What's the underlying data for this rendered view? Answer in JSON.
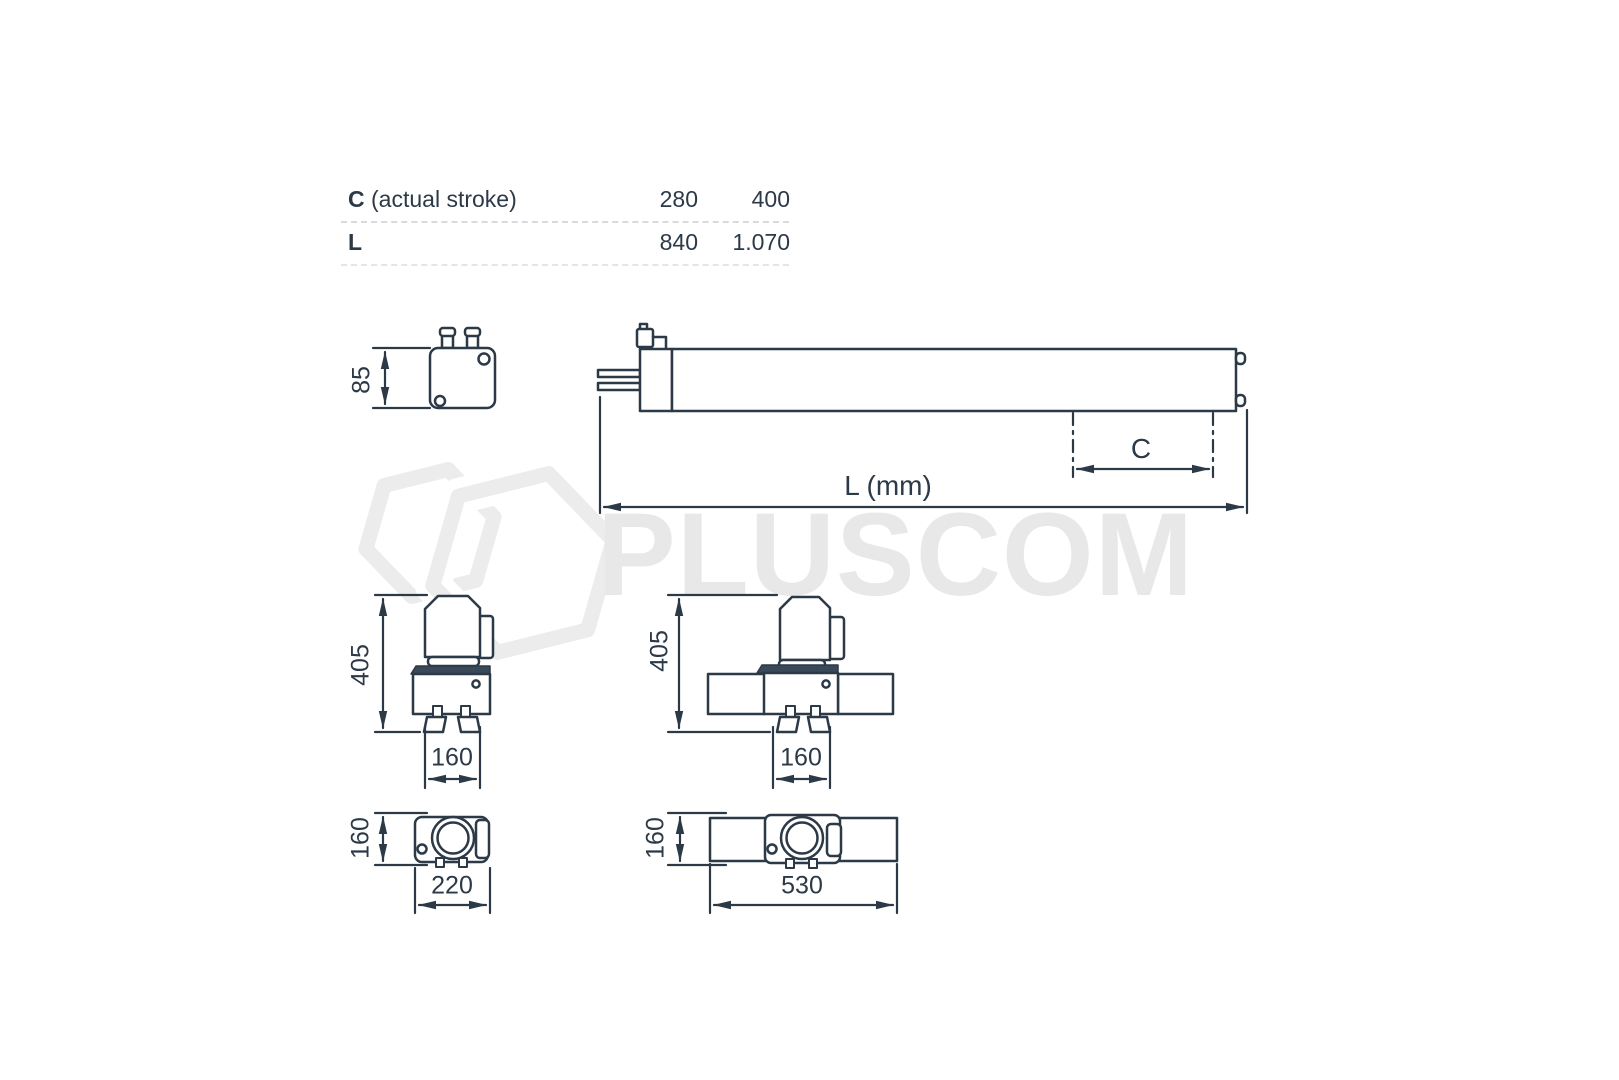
{
  "colors": {
    "line": "#2c3947",
    "plate_fill": "#3a4959",
    "watermark_gray": "#ebebeb",
    "separator": "#d7dbe0",
    "background": "#ffffff"
  },
  "watermark": {
    "brand": "PLUSCOM",
    "logo": "double-hexagon"
  },
  "spec_table": {
    "rows": [
      {
        "key": "C",
        "desc": " (actual stroke)",
        "values": [
          "280",
          "400"
        ]
      },
      {
        "key": "L",
        "desc": "",
        "values": [
          "840",
          "1.070"
        ]
      }
    ]
  },
  "views": {
    "end_view": {
      "height": "85"
    },
    "long_side_view": {
      "overall_length": "L (mm)",
      "stroke": "C"
    },
    "side_view_compact": {
      "height": "405",
      "mount_width": "160"
    },
    "side_view_extended": {
      "height": "405",
      "mount_width": "160"
    },
    "top_view_compact": {
      "depth": "160",
      "width": "220"
    },
    "top_view_extended": {
      "depth": "160",
      "width": "530"
    }
  }
}
